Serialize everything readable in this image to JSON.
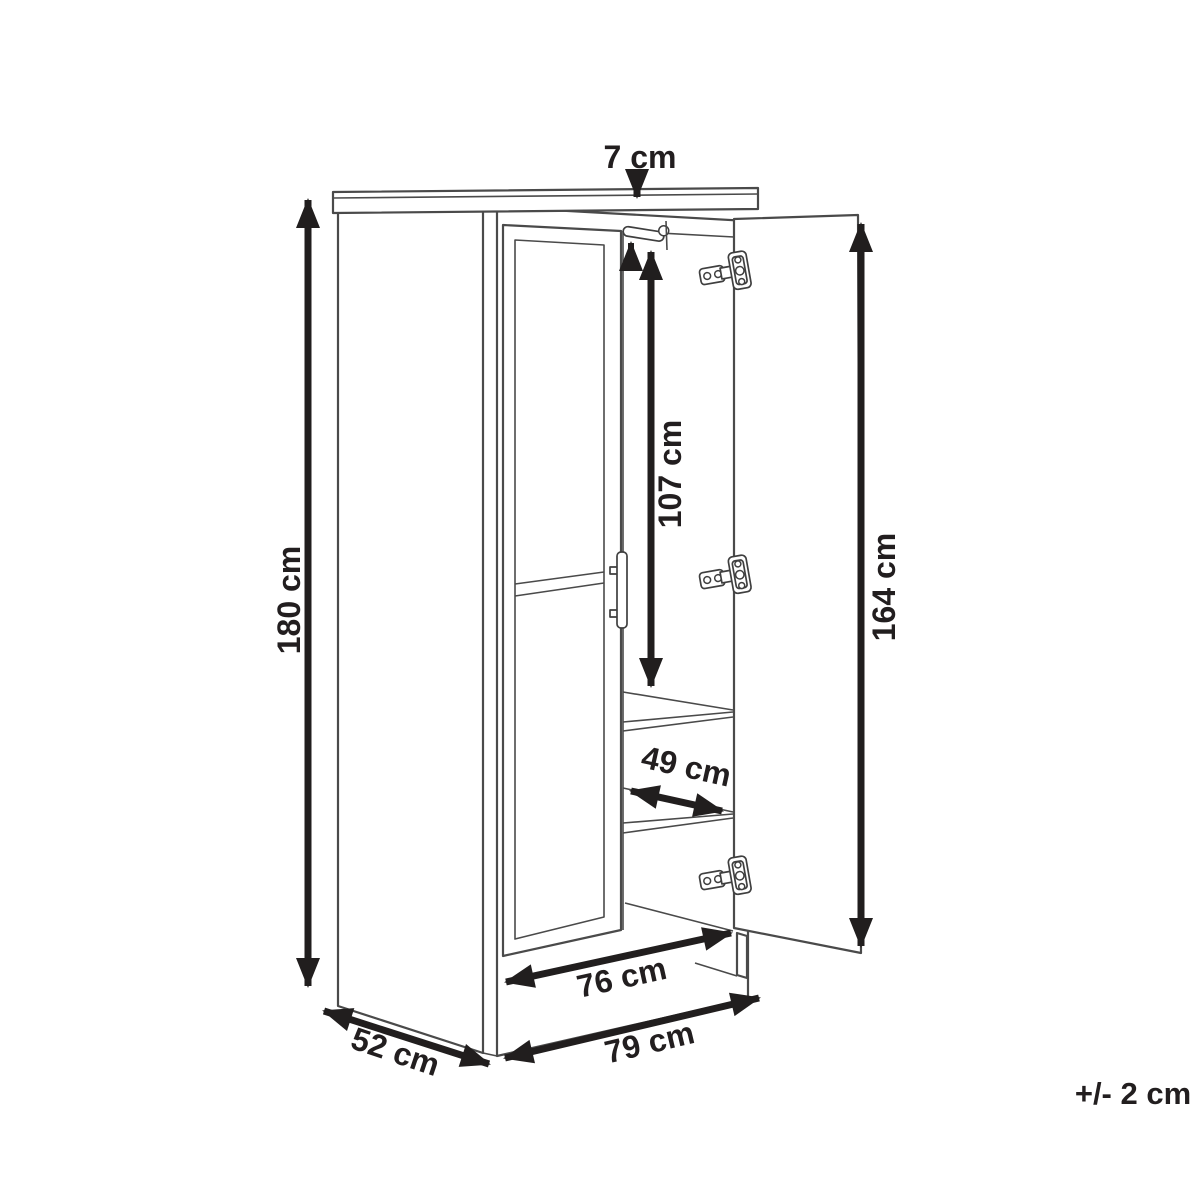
{
  "diagram": {
    "subject": "wardrobe-dimension-drawing",
    "labels": {
      "top_thickness": "7 cm",
      "height": "180 cm",
      "rail_height": "107 cm",
      "door_height": "164 cm",
      "shelf_width": "49 cm",
      "inner_width": "76 cm",
      "width": "79 cm",
      "depth": "52 cm",
      "tolerance": "+/- 2 cm"
    },
    "colors": {
      "background": "#ffffff",
      "drawing_line": "#4a4a4a",
      "dimension": "#211e1e"
    }
  }
}
